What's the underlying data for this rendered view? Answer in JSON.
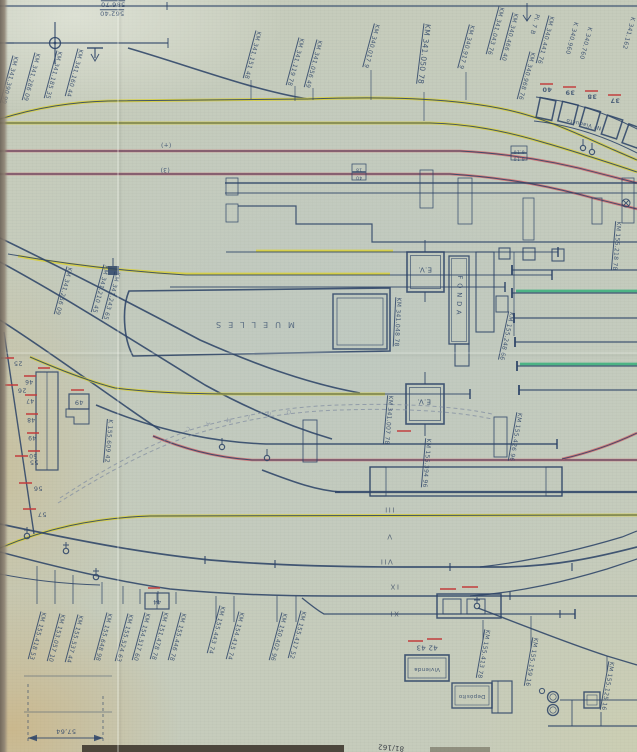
{
  "palette": {
    "paper": "#c6ccbc",
    "ink": "#2d4468",
    "yellow": "#d8cf35",
    "red": "#cf6066",
    "green": "#2fae77",
    "redmark": "#c23b3b",
    "faint": "#8691a3",
    "edge": "#6a6156"
  },
  "annotations": [
    {
      "name": "elevation-label",
      "text": "586'70",
      "x": 113,
      "y": 4,
      "rot": 180,
      "size": 6.5,
      "cls": "u"
    },
    {
      "name": "elevation-label",
      "text": "562'40",
      "x": 112,
      "y": 13,
      "rot": 180,
      "size": 6.5,
      "cls": "u"
    },
    {
      "name": "km-label",
      "text": "KM 341.390 99",
      "x": 9,
      "y": 80,
      "rot": 105,
      "size": 6,
      "cls": "u"
    },
    {
      "name": "km-label",
      "text": "KM 341.286 09",
      "x": 31,
      "y": 77,
      "rot": 105,
      "size": 6,
      "cls": "u"
    },
    {
      "name": "km-label",
      "text": "KM 341.185 35",
      "x": 53,
      "y": 75,
      "rot": 105,
      "size": 6,
      "cls": "u"
    },
    {
      "name": "km-label",
      "text": "KM 341.160 44",
      "x": 74,
      "y": 73,
      "rot": 105,
      "size": 6,
      "cls": "u"
    },
    {
      "name": "km-label",
      "text": "KM 341.151 48",
      "x": 252,
      "y": 55,
      "rot": 105,
      "size": 6,
      "cls": "u"
    },
    {
      "name": "km-label",
      "text": "KM 341.119 78",
      "x": 295,
      "y": 62,
      "rot": 105,
      "size": 6,
      "cls": "u"
    },
    {
      "name": "km-label",
      "text": "KM 341.056 49",
      "x": 313,
      "y": 64,
      "rot": 105,
      "size": 6,
      "cls": "u"
    },
    {
      "name": "km-label",
      "text": "KM 341.050 78",
      "x": 424,
      "y": 54,
      "rot": 97,
      "size": 7.5,
      "cls": "u"
    },
    {
      "name": "km-label",
      "text": "KM 340.017 9",
      "x": 371,
      "y": 46,
      "rot": 105,
      "size": 6,
      "cls": "u"
    },
    {
      "name": "km-label",
      "text": "KM 340.917 9",
      "x": 466,
      "y": 47,
      "rot": 105,
      "size": 6,
      "cls": "u"
    },
    {
      "name": "km-label",
      "text": "KM 341.043 76",
      "x": 495,
      "y": 31,
      "rot": 105,
      "size": 6,
      "cls": "u"
    },
    {
      "name": "km-label",
      "text": "KM 340.466 40",
      "x": 509,
      "y": 37,
      "rot": 105,
      "size": 6,
      "cls": "u"
    },
    {
      "name": "km-label",
      "text": "KM 340.968 76",
      "x": 526,
      "y": 76,
      "rot": 105,
      "size": 6,
      "cls": "u"
    },
    {
      "name": "plate-label",
      "text": "Pl. 7 B",
      "x": 534,
      "y": 24,
      "rot": 105,
      "size": 6
    },
    {
      "name": "km-label",
      "text": "KM 340.441 76",
      "x": 545,
      "y": 40,
      "rot": 105,
      "size": 6,
      "cls": "u"
    },
    {
      "name": "km-label",
      "text": "K 340.960",
      "x": 571,
      "y": 38,
      "rot": 105,
      "size": 6
    },
    {
      "name": "km-label",
      "text": "K 340.760",
      "x": 585,
      "y": 43,
      "rot": 105,
      "size": 6
    },
    {
      "name": "km-label",
      "text": "K 341.162",
      "x": 628,
      "y": 33,
      "rot": 105,
      "size": 6
    },
    {
      "name": "viaduct-number",
      "text": "40",
      "x": 547,
      "y": 89,
      "rot": 180,
      "size": 6.5,
      "cls": "num"
    },
    {
      "name": "viaduct-number",
      "text": "39",
      "x": 570,
      "y": 92,
      "rot": 180,
      "size": 6.5,
      "cls": "num"
    },
    {
      "name": "viaduct-number",
      "text": "38",
      "x": 592,
      "y": 96,
      "rot": 180,
      "size": 6.5,
      "cls": "num"
    },
    {
      "name": "viaduct-number",
      "text": "37",
      "x": 615,
      "y": 100,
      "rot": 180,
      "size": 6.5,
      "cls": "num"
    },
    {
      "name": "viaduct-label",
      "text": "Nº Viaducto",
      "x": 584,
      "y": 123,
      "rot": 193,
      "size": 5.5
    },
    {
      "name": "track-mark",
      "text": "(+)",
      "x": 166,
      "y": 144,
      "rot": 180,
      "size": 6
    },
    {
      "name": "track-mark",
      "text": "(3)",
      "x": 165,
      "y": 169,
      "rot": 180,
      "size": 6
    },
    {
      "name": "level-mark",
      "text": "6.10",
      "x": 519,
      "y": 150,
      "rot": 180,
      "size": 4.5
    },
    {
      "name": "level-mark",
      "text": "6.10",
      "x": 519,
      "y": 157,
      "rot": 180,
      "size": 4.5
    },
    {
      "name": "level-mark",
      "text": "18",
      "x": 359,
      "y": 168,
      "rot": 180,
      "size": 4.5
    },
    {
      "name": "level-mark",
      "text": "40",
      "x": 359,
      "y": 176,
      "rot": 180,
      "size": 4.5
    },
    {
      "name": "km-label",
      "text": "KM 341.256 09",
      "x": 63,
      "y": 291,
      "rot": 105,
      "size": 6,
      "cls": "u"
    },
    {
      "name": "km-label",
      "text": "KM 341.210 45",
      "x": 100,
      "y": 289,
      "rot": 105,
      "size": 6,
      "cls": "u"
    },
    {
      "name": "km-label",
      "text": "KM 341.243 65",
      "x": 111,
      "y": 296,
      "rot": 105,
      "size": 6,
      "cls": "u"
    },
    {
      "name": "building-label",
      "text": "MUELLES",
      "x": 252,
      "y": 324,
      "rot": 180,
      "size": 8,
      "cls": "sp"
    },
    {
      "name": "km-label",
      "text": "KM 341.048 78",
      "x": 397,
      "y": 322,
      "rot": 93,
      "size": 6,
      "cls": "u"
    },
    {
      "name": "building-label",
      "text": "E.V.",
      "x": 425,
      "y": 269,
      "rot": 180,
      "size": 7
    },
    {
      "name": "building-label",
      "text": "E.V.",
      "x": 424,
      "y": 401,
      "rot": 180,
      "size": 7
    },
    {
      "name": "building-label",
      "text": "FONDA",
      "x": 459,
      "y": 297,
      "rot": 92,
      "size": 6.5,
      "cls": "sp2"
    },
    {
      "name": "km-label",
      "text": "KM 155.248 66",
      "x": 506,
      "y": 336,
      "rot": 102,
      "size": 6,
      "cls": "u"
    },
    {
      "name": "km-label",
      "text": "KM 155.218 78",
      "x": 616,
      "y": 246,
      "rot": 95,
      "size": 6,
      "cls": "u"
    },
    {
      "name": "km-label",
      "text": "KM 341.007 78",
      "x": 388,
      "y": 420,
      "rot": 95,
      "size": 6,
      "cls": "u"
    },
    {
      "name": "km-label",
      "text": "KM 155.394 96",
      "x": 426,
      "y": 463,
      "rot": 95,
      "size": 6,
      "cls": "u"
    },
    {
      "name": "km-label",
      "text": "KM 155.426 96",
      "x": 515,
      "y": 437,
      "rot": 100,
      "size": 6,
      "cls": "u"
    },
    {
      "name": "km-label",
      "text": "K 155.609 42",
      "x": 108,
      "y": 441,
      "rot": 95,
      "size": 6,
      "cls": "u"
    },
    {
      "name": "road-letter",
      "text": "C",
      "x": 188,
      "y": 428,
      "rot": 192,
      "size": 6,
      "cls": "faint"
    },
    {
      "name": "road-letter",
      "text": "A",
      "x": 208,
      "y": 423,
      "rot": 192,
      "size": 6,
      "cls": "faint"
    },
    {
      "name": "road-letter",
      "text": "M",
      "x": 229,
      "y": 419,
      "rot": 192,
      "size": 6,
      "cls": "faint"
    },
    {
      "name": "road-letter",
      "text": "I",
      "x": 249,
      "y": 416,
      "rot": 192,
      "size": 6,
      "cls": "faint"
    },
    {
      "name": "road-letter",
      "text": "N",
      "x": 269,
      "y": 413,
      "rot": 192,
      "size": 6,
      "cls": "faint"
    },
    {
      "name": "road-letter",
      "text": "O",
      "x": 289,
      "y": 411,
      "rot": 192,
      "size": 6,
      "cls": "faint"
    },
    {
      "name": "building-number",
      "text": "49",
      "x": 79,
      "y": 402,
      "rot": 180,
      "size": 6.5
    },
    {
      "name": "platform-number",
      "text": "46",
      "x": 29,
      "y": 381,
      "rot": 180,
      "size": 6
    },
    {
      "name": "platform-number",
      "text": "47",
      "x": 30,
      "y": 400,
      "rot": 180,
      "size": 6
    },
    {
      "name": "platform-number",
      "text": "48",
      "x": 31,
      "y": 419,
      "rot": 180,
      "size": 6
    },
    {
      "name": "platform-number",
      "text": "49",
      "x": 32,
      "y": 437,
      "rot": 180,
      "size": 6
    },
    {
      "name": "platform-number",
      "text": "50",
      "x": 33,
      "y": 455,
      "rot": 180,
      "size": 6
    },
    {
      "name": "switch-number",
      "text": "25",
      "x": 18,
      "y": 363,
      "rot": 180,
      "size": 6.5
    },
    {
      "name": "switch-number",
      "text": "26",
      "x": 22,
      "y": 390,
      "rot": 180,
      "size": 6.5
    },
    {
      "name": "switch-number",
      "text": "55",
      "x": 34,
      "y": 462,
      "rot": 180,
      "size": 6.5
    },
    {
      "name": "switch-number",
      "text": "56",
      "x": 38,
      "y": 488,
      "rot": 180,
      "size": 6.5
    },
    {
      "name": "switch-number",
      "text": "57",
      "x": 42,
      "y": 514,
      "rot": 180,
      "size": 6.5
    },
    {
      "name": "track-number",
      "text": "III",
      "x": 389,
      "y": 509,
      "rot": 180,
      "size": 7,
      "cls": "rn"
    },
    {
      "name": "track-number",
      "text": "V",
      "x": 389,
      "y": 536,
      "rot": 180,
      "size": 7,
      "cls": "rn"
    },
    {
      "name": "track-number",
      "text": "VII",
      "x": 386,
      "y": 561,
      "rot": 180,
      "size": 7,
      "cls": "rn"
    },
    {
      "name": "track-number",
      "text": "IX",
      "x": 394,
      "y": 586,
      "rot": 180,
      "size": 7,
      "cls": "rn"
    },
    {
      "name": "track-number",
      "text": "XI",
      "x": 394,
      "y": 613,
      "rot": 180,
      "size": 7,
      "cls": "rn"
    },
    {
      "name": "building-number",
      "text": "44",
      "x": 157,
      "y": 601,
      "rot": 180,
      "size": 6
    },
    {
      "name": "building-number",
      "text": "42  43",
      "x": 427,
      "y": 647,
      "rot": 180,
      "size": 7
    },
    {
      "name": "building-label",
      "text": "Vivienda",
      "x": 427,
      "y": 668,
      "rot": 180,
      "size": 5.5
    },
    {
      "name": "building-label",
      "text": "Depósito",
      "x": 472,
      "y": 695,
      "rot": 180,
      "size": 5.5
    },
    {
      "name": "km-label",
      "text": "KM 155.418 53",
      "x": 37,
      "y": 636,
      "rot": 105,
      "size": 6,
      "cls": "u"
    },
    {
      "name": "km-label",
      "text": "KM 153.057 10",
      "x": 56,
      "y": 638,
      "rot": 105,
      "size": 6,
      "cls": "u"
    },
    {
      "name": "km-label",
      "text": "KM 155.537 44",
      "x": 74,
      "y": 639,
      "rot": 105,
      "size": 6,
      "cls": "u"
    },
    {
      "name": "km-label",
      "text": "KM 155.648 98",
      "x": 103,
      "y": 637,
      "rot": 105,
      "size": 6,
      "cls": "u"
    },
    {
      "name": "km-label",
      "text": "KM 155.524 63",
      "x": 124,
      "y": 638,
      "rot": 105,
      "size": 6,
      "cls": "u"
    },
    {
      "name": "km-label",
      "text": "KM 154.517 60",
      "x": 141,
      "y": 637,
      "rot": 105,
      "size": 6,
      "cls": "u"
    },
    {
      "name": "km-label",
      "text": "KM 151.478 78",
      "x": 159,
      "y": 636,
      "rot": 105,
      "size": 6,
      "cls": "u"
    },
    {
      "name": "km-label",
      "text": "KM 155.446 78",
      "x": 177,
      "y": 637,
      "rot": 105,
      "size": 6,
      "cls": "u"
    },
    {
      "name": "km-label",
      "text": "KM 155.443 74",
      "x": 216,
      "y": 630,
      "rot": 105,
      "size": 6,
      "cls": "u"
    },
    {
      "name": "km-label",
      "text": "KM 154.415 74",
      "x": 235,
      "y": 636,
      "rot": 105,
      "size": 6,
      "cls": "u"
    },
    {
      "name": "km-label",
      "text": "KM 150.402 96",
      "x": 278,
      "y": 637,
      "rot": 105,
      "size": 6,
      "cls": "u"
    },
    {
      "name": "km-label",
      "text": "KM 155.417 52",
      "x": 297,
      "y": 635,
      "rot": 105,
      "size": 6,
      "cls": "u"
    },
    {
      "name": "km-label",
      "text": "KM 155.413 78",
      "x": 483,
      "y": 654,
      "rot": 100,
      "size": 6,
      "cls": "u"
    },
    {
      "name": "km-label",
      "text": "KM 155.159 16",
      "x": 531,
      "y": 662,
      "rot": 100,
      "size": 6,
      "cls": "u"
    },
    {
      "name": "km-label",
      "text": "KM 155.125 16",
      "x": 607,
      "y": 686,
      "rot": 100,
      "size": 6,
      "cls": "u"
    },
    {
      "name": "dimension-label",
      "text": "57,64",
      "x": 66,
      "y": 731,
      "rot": 180,
      "size": 6.5
    },
    {
      "name": "sheet-number",
      "text": "81/162",
      "x": 391,
      "y": 747,
      "rot": 185,
      "size": 7,
      "cls": "dark"
    }
  ]
}
